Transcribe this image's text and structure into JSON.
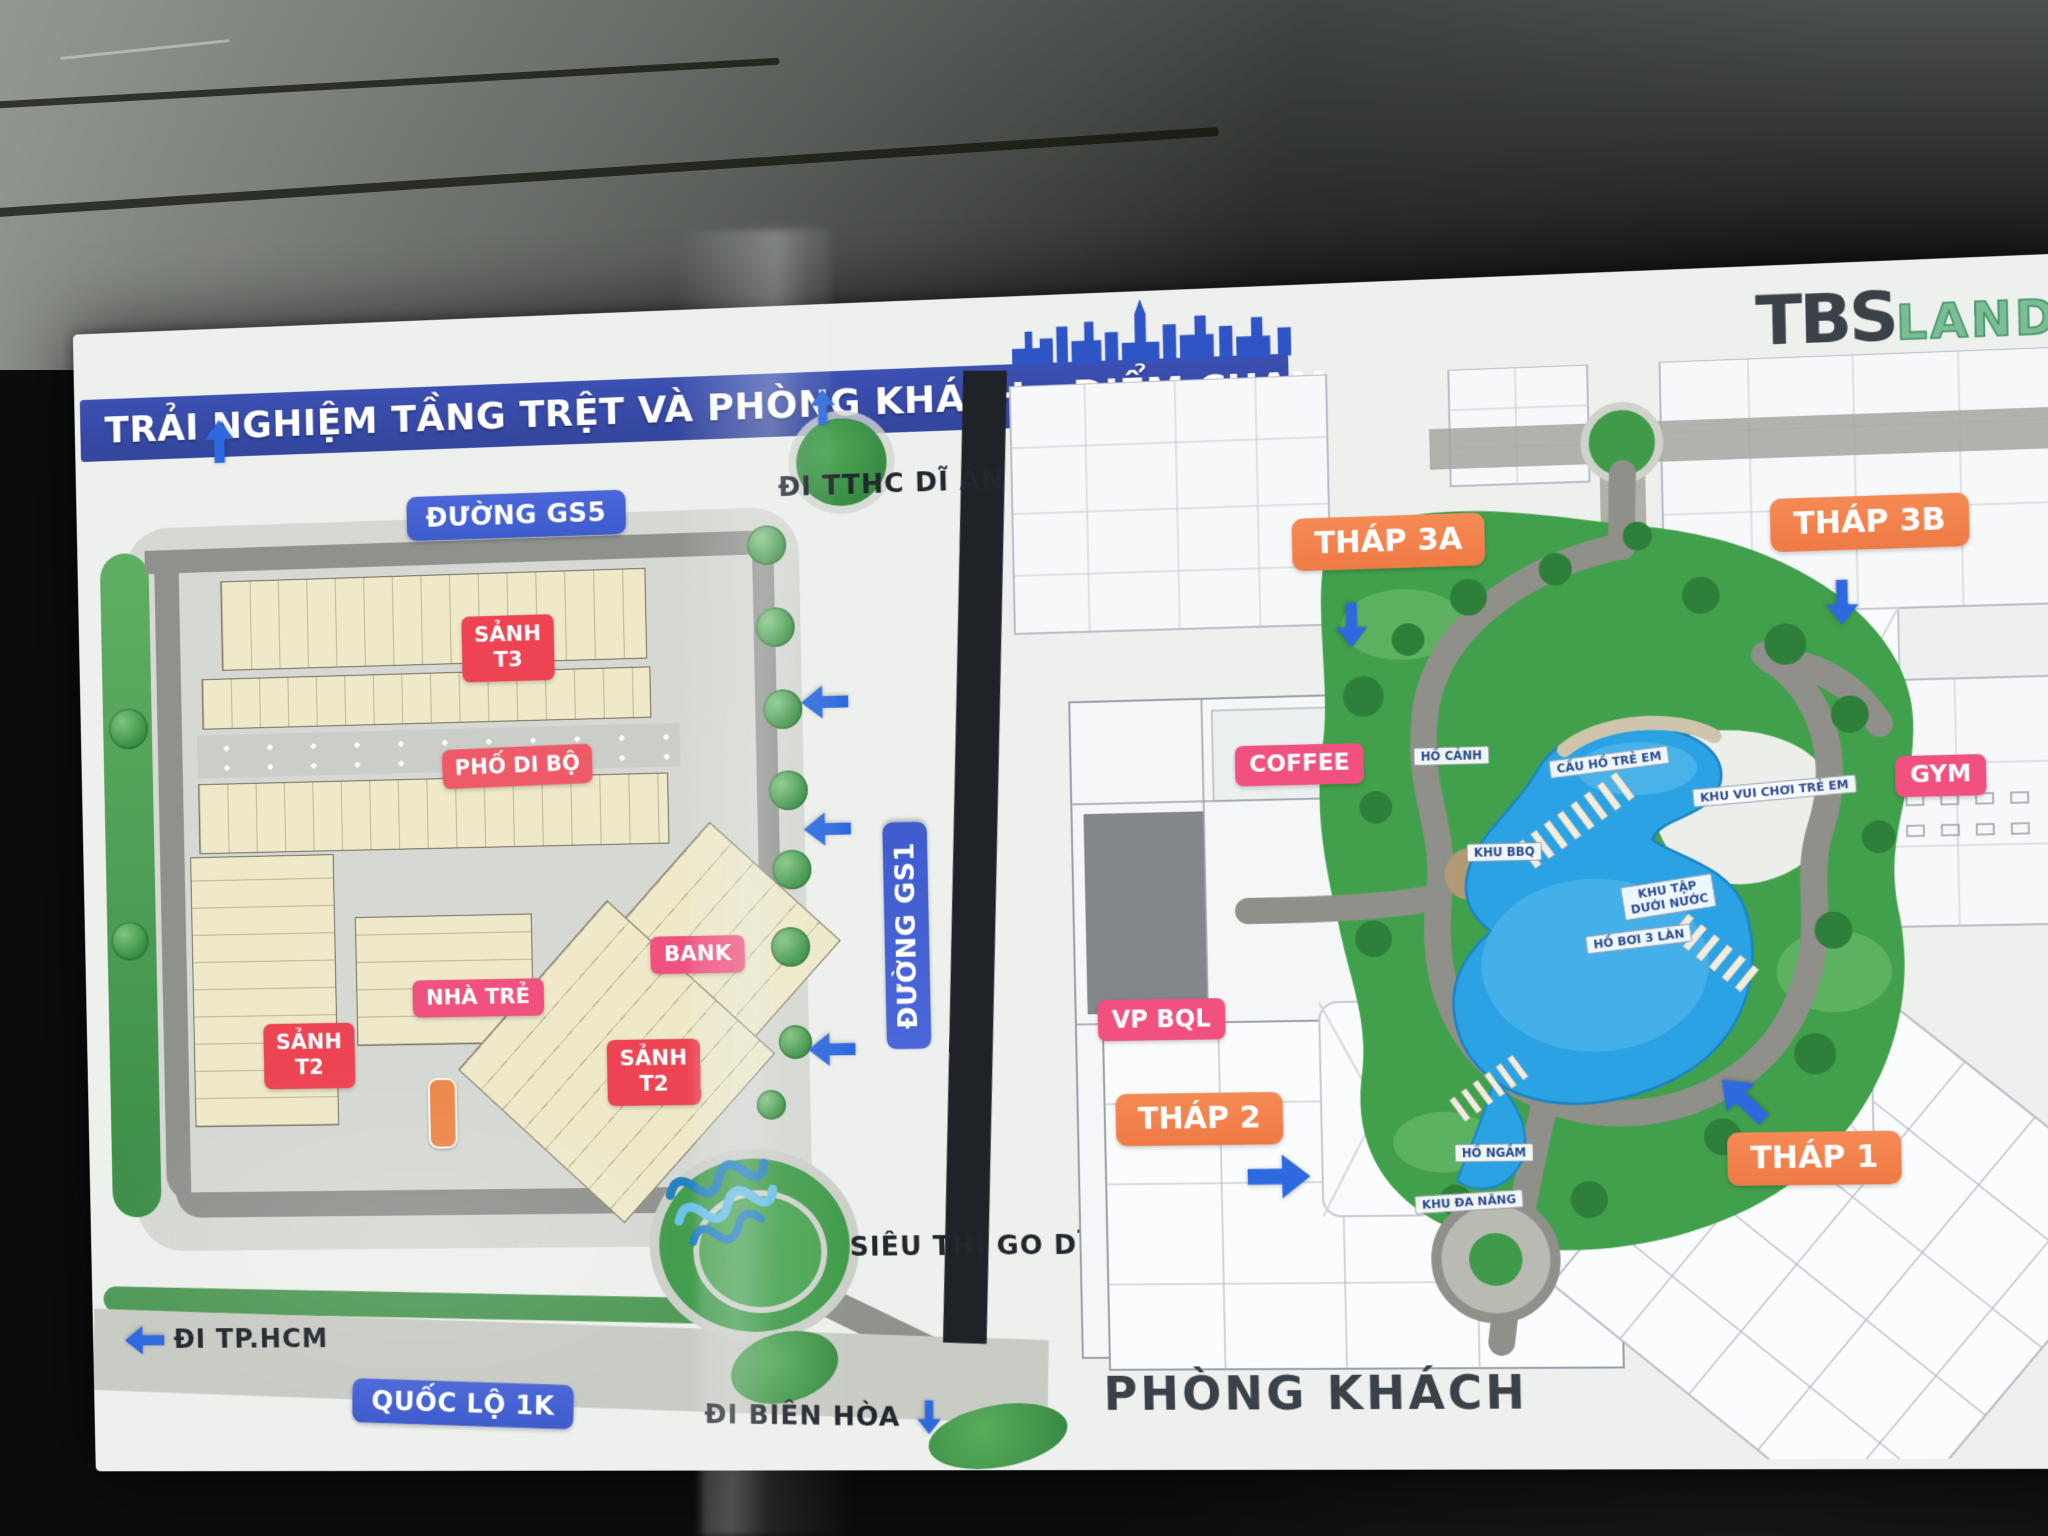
{
  "colors": {
    "banner_blue": "#3c50b2",
    "road_pill_blue": "#3f5ccd",
    "arrow_blue": "#2e6adf",
    "label_red": "#ed4352",
    "label_pink": "#f0517e",
    "label_orange": "#ef7a45",
    "pool_blue": "#2ba2e4",
    "landscape_green": "#41a04c",
    "building_cream": "#efe9c9",
    "logo_dark": "#3a4147",
    "caption_dark": "#3b4149"
  },
  "header": {
    "title": "TRẢI NGHIỆM TẦNG TRỆT VÀ PHÒNG KHÁCH – ĐIỂM CHẠM",
    "logo_primary": "TBS",
    "logo_secondary": "LAND"
  },
  "left_plan": {
    "roads": {
      "gs5": "ĐƯỜNG GS5",
      "gs1": "ĐƯỜNG GS1",
      "ql_1k": "QUỐC LỘ 1K"
    },
    "directions": {
      "tthc_di_an": "ĐI TTHC DĨ AN",
      "tp_hcm": "ĐI TP.HCM",
      "bien_hoa": "ĐI BIÊN HÒA"
    },
    "places": {
      "sanh_t3": "SẢNH\nT3",
      "pho_di_bo": "PHỐ DI BỘ",
      "bank": "BANK",
      "nha_tre": "NHÀ TRẺ",
      "sanh_t2_center": "SẢNH\nT2",
      "sanh_t2_left": "SẢNH\nT2",
      "sieu_thi_go": "SIÊU THỊ\nGO DĨ AN"
    }
  },
  "right_plan": {
    "towers": {
      "thap_3a": "THÁP 3A",
      "thap_3b": "THÁP 3B",
      "thap_2": "THÁP 2",
      "thap_1": "THÁP 1"
    },
    "amenities": {
      "coffee": "COFFEE",
      "gym": "GYM",
      "vp_bql": "VP BQL"
    },
    "water_features": {
      "ho_canh": "HỒ CẢNH",
      "cau_ho_tre_em": "CẦU HỒ TRẺ EM",
      "khu_vui_choi_tre_em": "KHU VUI CHƠI TRẺ EM",
      "khu_bbq": "KHU BBQ",
      "khu_tap_duoi_nuoc": "KHU TẬP\nDƯỚI NƯỚC",
      "ho_boi_3_lan": "HỒ BƠI 3 LÀN",
      "ho_ngam": "HỒ NGẮM",
      "khu_da_nang": "KHU ĐA NĂNG"
    },
    "caption": "PHÒNG KHÁCH"
  }
}
